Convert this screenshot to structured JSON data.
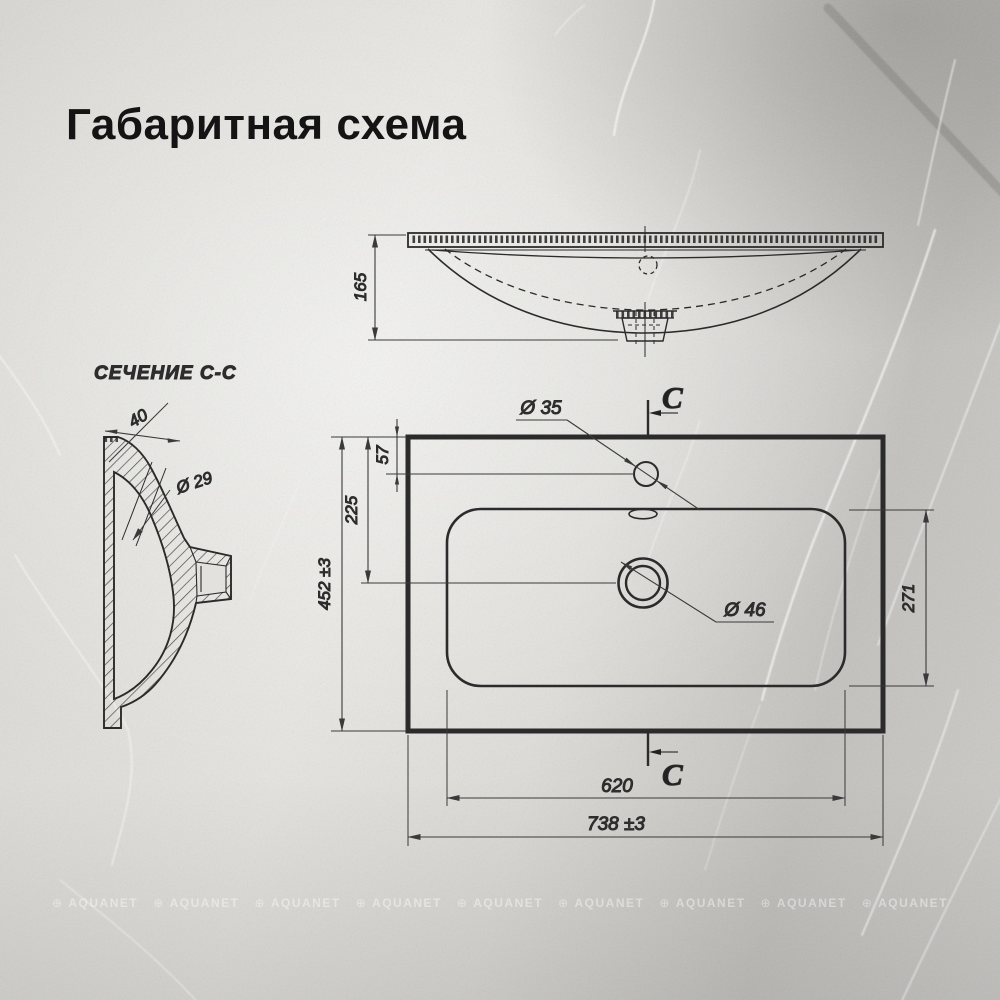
{
  "title": "Габаритная схема",
  "watermark": {
    "text": "AQUANET"
  },
  "colors": {
    "background": "#d8d7d2",
    "line": "#2b2b2b",
    "dimension": "#3a3a3a",
    "title_text": "#141414",
    "watermark": "#ffffff"
  },
  "front_view": {
    "dims": {
      "height": "165"
    }
  },
  "section_view": {
    "label": "СЕЧЕНИЕ С-С",
    "dims": {
      "rim_width": "40",
      "overflow_diameter": "Ø 29"
    }
  },
  "top_view": {
    "section_marker": "C",
    "dims": {
      "faucet_diameter": "Ø 35",
      "faucet_offset": "57",
      "drain_offset": "225",
      "depth": "452 ±3",
      "bowl_depth": "271",
      "drain_diameter": "Ø 46",
      "bowl_width": "620",
      "width": "738 ±3"
    }
  }
}
